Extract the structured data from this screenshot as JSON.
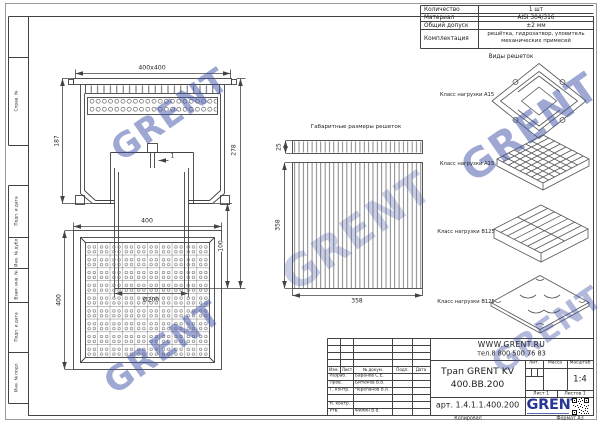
{
  "sheet": {
    "copied_label": "Копировал",
    "format_label": "Формат А3"
  },
  "frame_labels": {
    "left": [
      "Справ. №",
      "Подп. и дата",
      "Инв. № дубл.",
      "Взам. инв. №",
      "Подп. и дата",
      "Инв. № подл."
    ]
  },
  "spec_table": {
    "rows": [
      {
        "label": "Количество",
        "value": "1 шт"
      },
      {
        "label": "Материал",
        "value": "AISI 304/316"
      },
      {
        "label": "Общий допуск",
        "value": "±2 мм"
      },
      {
        "label": "Комплектация",
        "value": "решётка, гидрозатвор, уловитель",
        "value2": "механических примесей"
      }
    ]
  },
  "views_panel": {
    "title": "Виды решеток",
    "items": [
      {
        "label": "Класс нагрузки А15"
      },
      {
        "label": "Класс нагрузки А15"
      },
      {
        "label": "Класс нагрузки B125"
      },
      {
        "label": "Класс нагрузки B125"
      }
    ]
  },
  "center_view": {
    "title": "Габаритные размеры решеток",
    "dim_thickness": "25",
    "dim_width": "358",
    "dim_length": "358"
  },
  "front_view": {
    "dim_overall": "400x400",
    "dim_body_height": "187",
    "dim_total_height": "278",
    "dim_outlet": "100",
    "dim_diameter": "Ø200",
    "dim_wall": "1"
  },
  "plan_view": {
    "dim_width": "400",
    "dim_height": "400"
  },
  "title_block": {
    "website": "WWW.GRENT.RU",
    "phone": "тел.8 800 500 76 83",
    "product_line1": "Трап GRENT KV",
    "product_line2": "400.BB.200",
    "article": "арт. 1.4.1.1.400.200",
    "lit_label": "Лит.",
    "mass_label": "Масса",
    "scale_label": "Масштаб",
    "scale": "1:4",
    "sheet_no": "Лист 1",
    "sheets_total": "Листов 1",
    "logo": "GRENT",
    "columns": [
      "Изм.",
      "Лист",
      "№ докум.",
      "Подп.",
      "Дата"
    ],
    "rows": [
      {
        "role": "Разраб.",
        "name": "Баранов С.Е."
      },
      {
        "role": "Пров.",
        "name": "Битюков В.В."
      },
      {
        "role": "Т. контр.",
        "name": "Черепанов В.А."
      },
      {
        "role": "Н. контр.",
        "name": ""
      },
      {
        "role": "Утв.",
        "name": "Филин В.В."
      }
    ]
  },
  "watermark": {
    "text": "GRENT",
    "color": "#3f51a5"
  },
  "colors": {
    "line": "#434343",
    "accent_blue": "#283593"
  }
}
